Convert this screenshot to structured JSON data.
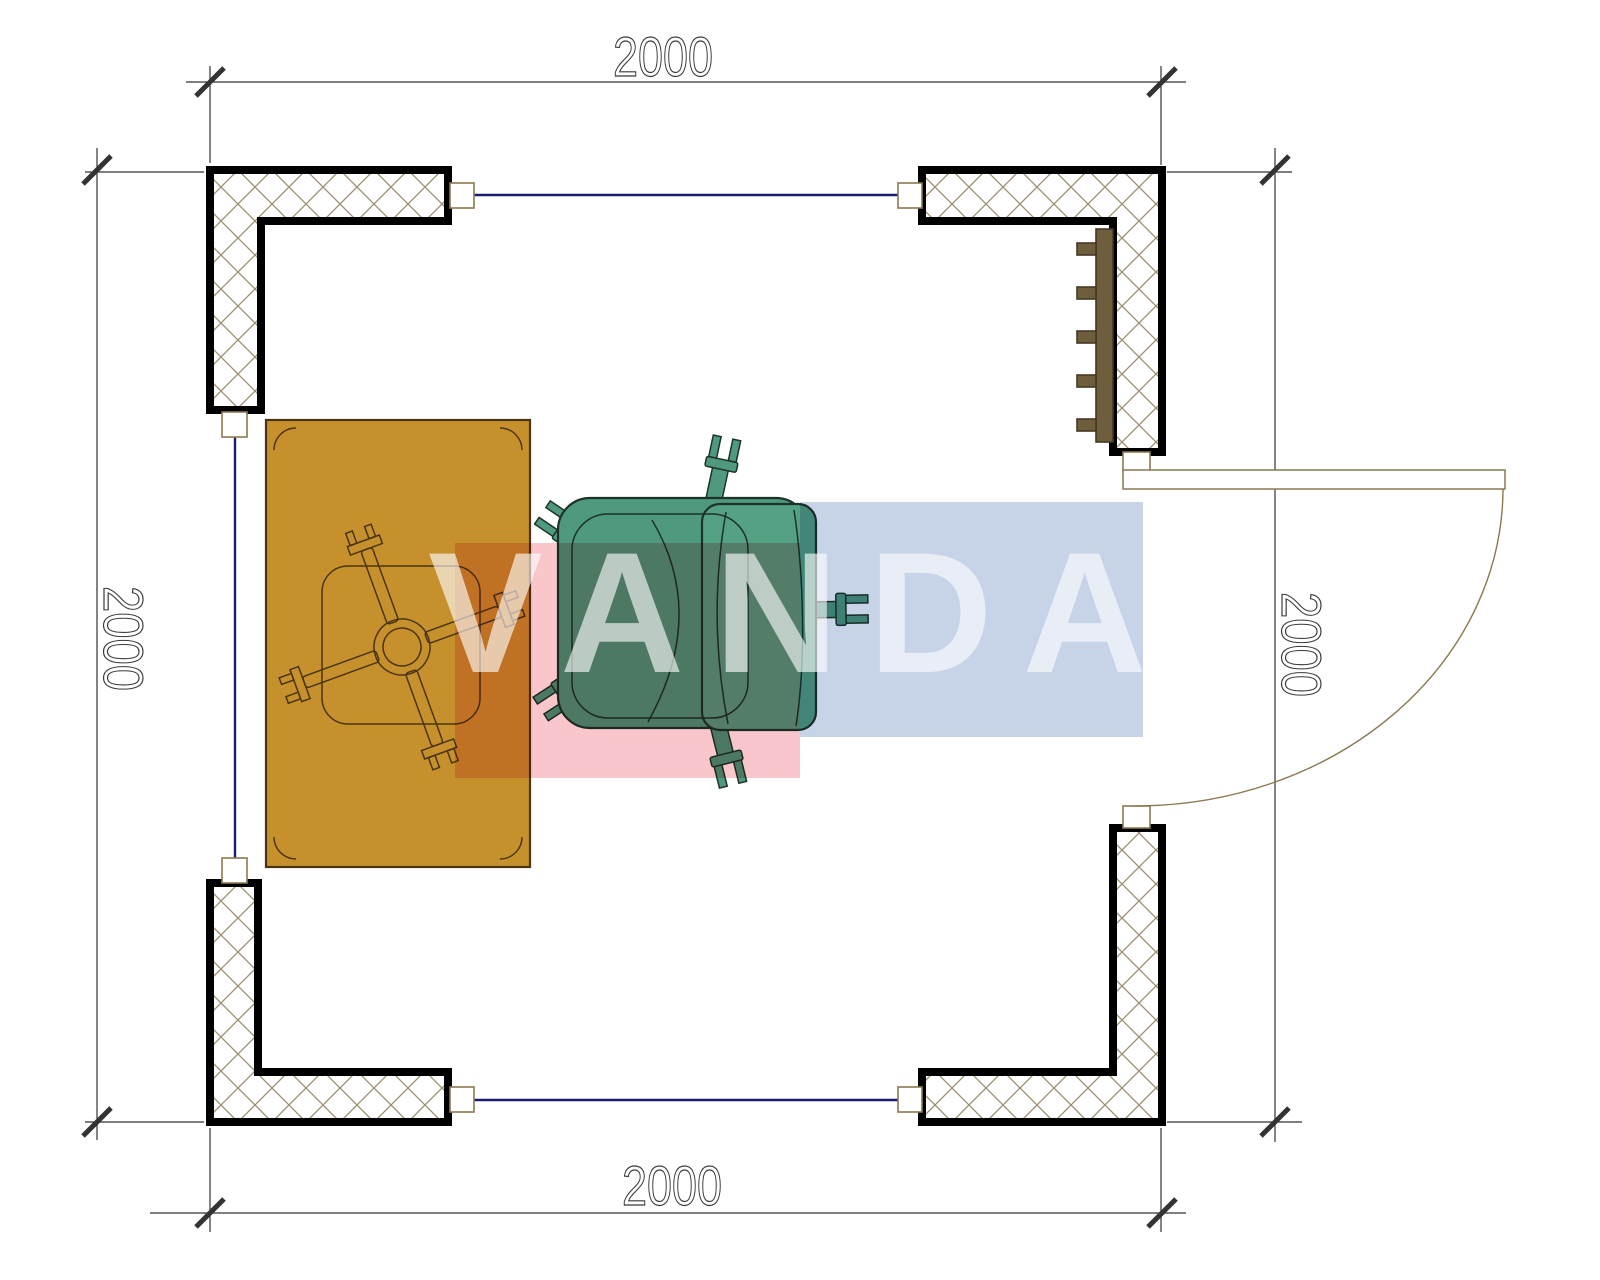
{
  "drawing": {
    "type": "floor-plan",
    "room_outer_size_mm": "2000 x 2000",
    "dimensions": {
      "top": "2000",
      "bottom": "2000",
      "left": "2000",
      "right": "2000"
    },
    "watermark": {
      "text": "VANDA",
      "pink_block_color": "#f8c6cb",
      "blue_block_color": "#c7d4e8",
      "text_color": "#ffffff"
    },
    "colors": {
      "wall_outline": "#000000",
      "hatch_line": "#9c8f70",
      "thin_wall_line": "#1b1b6f",
      "frame_outline": "#8a7950",
      "dim_line": "#333333",
      "table_fill": "#c6912d",
      "table_outline": "#4a3510",
      "chair_fill": "#4f9a7e",
      "chair_back_fill": "#55a184",
      "chair_outline": "#1d3329",
      "radiator_fill": "#6f5e3d",
      "radiator_outline": "#453823"
    },
    "elements": [
      "corner-wall-top-left",
      "corner-wall-top-right",
      "corner-wall-bottom-left",
      "corner-wall-bottom-right",
      "radiator",
      "door",
      "table",
      "office-chair"
    ]
  }
}
